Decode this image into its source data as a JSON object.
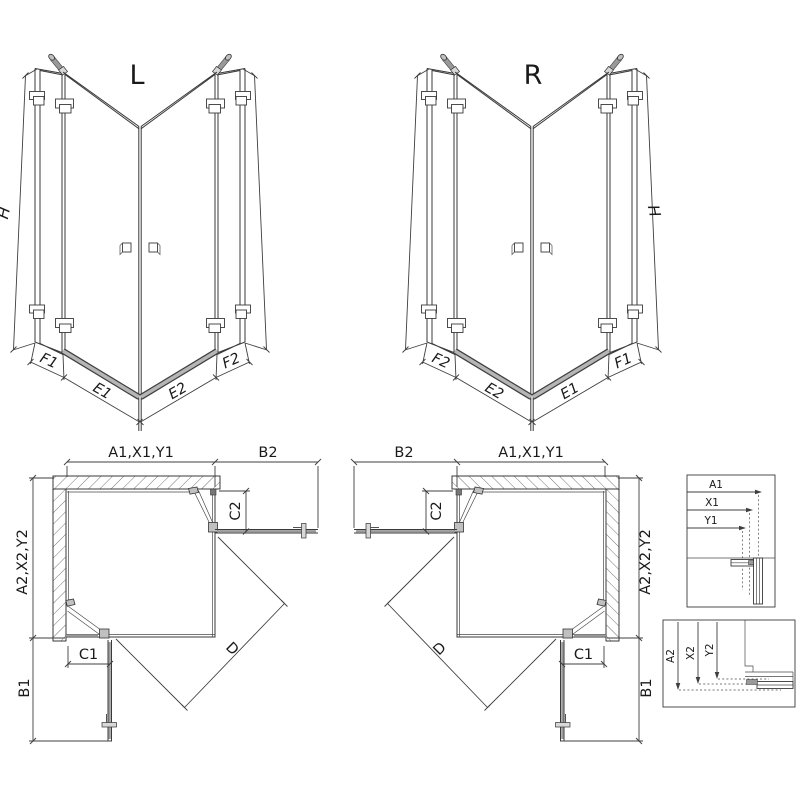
{
  "drawing": {
    "type": "shower-enclosure-technical-diagram",
    "colors": {
      "line": "#3a3a3a",
      "fitting_gray": "#9a9a9a",
      "threshold_gray": "#b5b5b5",
      "text": "#1a1a1a",
      "background": "#ffffff"
    },
    "front_views": [
      {
        "label": "L",
        "height_dim": "H",
        "bottom_dims": [
          "F1",
          "E1",
          "E2",
          "F2"
        ]
      },
      {
        "label": "R",
        "height_dim": "H",
        "bottom_dims": [
          "F2",
          "E2",
          "E1",
          "F1"
        ]
      }
    ],
    "plan_views": [
      {
        "position": "left",
        "top_dims": [
          "A1,X1,Y1",
          "B2"
        ],
        "side_dims": [
          "A2,X2,Y2",
          "B1"
        ],
        "inner_dims": {
          "door_top": "C2",
          "door_bottom": "C1",
          "diagonal": "D"
        }
      },
      {
        "position": "right",
        "top_dims": [
          "B2",
          "A1,X1,Y1"
        ],
        "side_dims": [
          "A2,X2,Y2",
          "B1"
        ],
        "inner_dims": {
          "door_top": "C2",
          "door_bottom": "C1",
          "diagonal": "D"
        }
      }
    ],
    "detail_insets": [
      {
        "orientation": "horizontal",
        "arrows": [
          "A1",
          "X1",
          "Y1"
        ]
      },
      {
        "orientation": "vertical",
        "arrows": [
          "A2",
          "X2",
          "Y2"
        ]
      }
    ]
  }
}
